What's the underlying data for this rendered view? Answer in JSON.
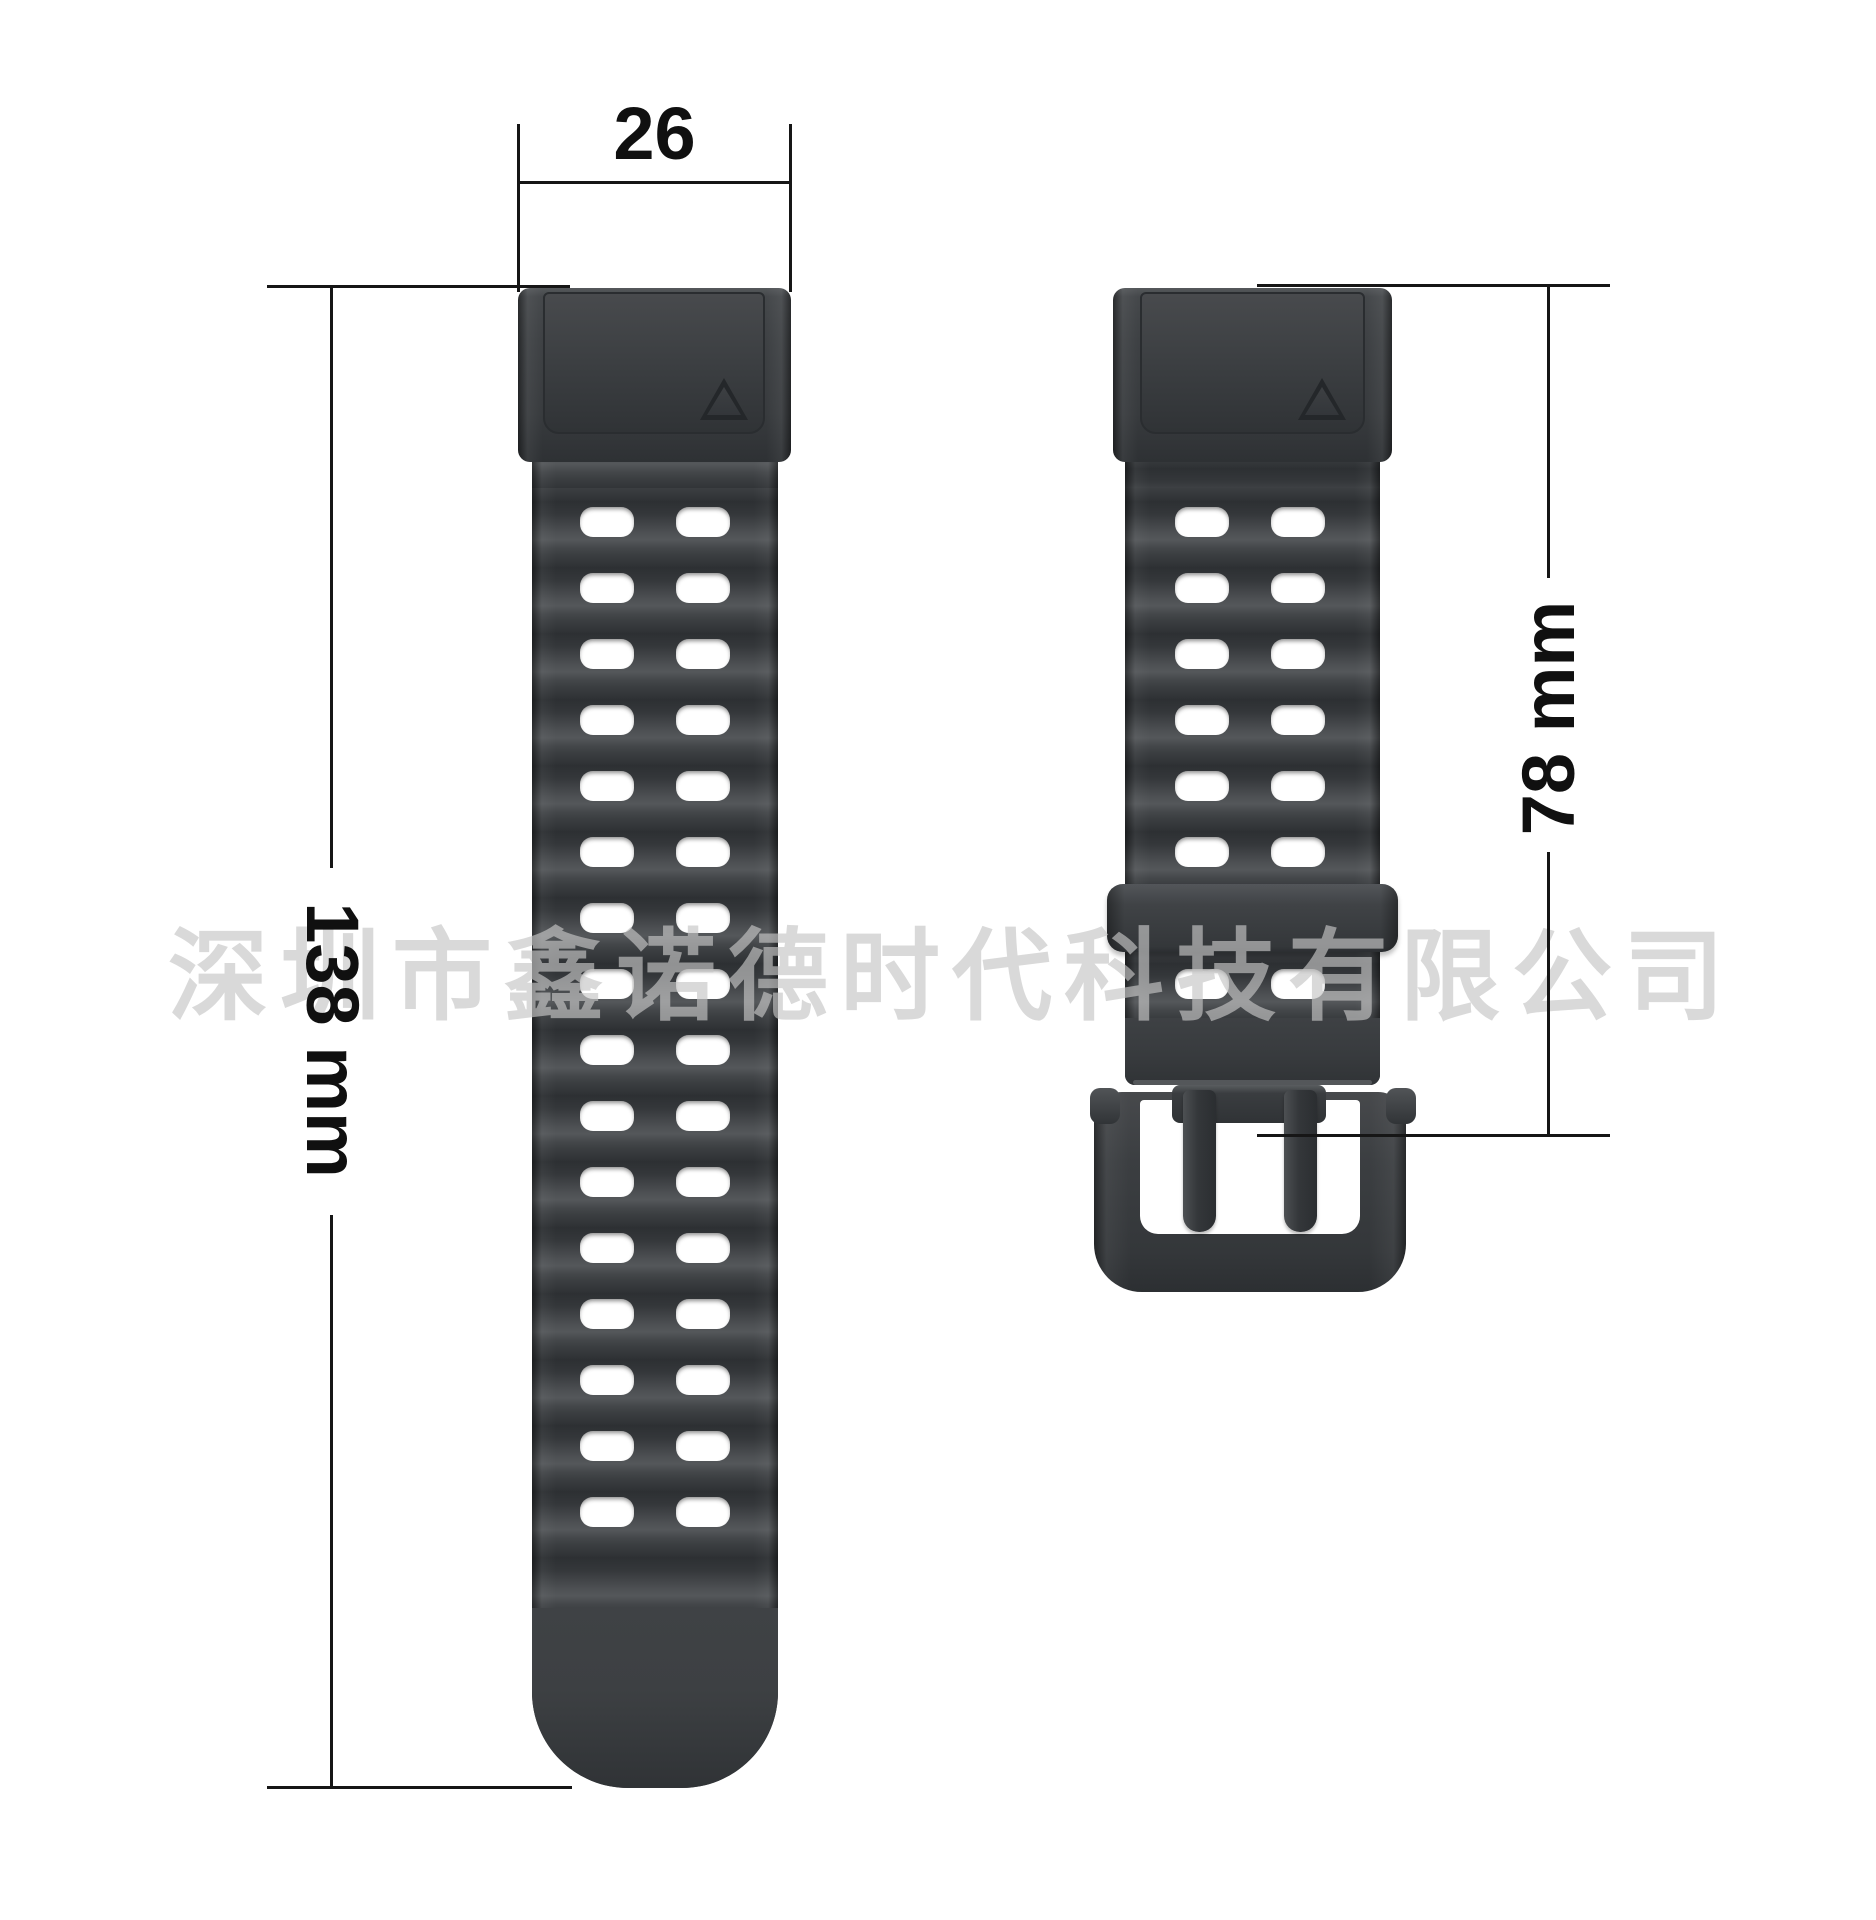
{
  "watermark_text": "深圳市鑫诺德时代科技有限公司",
  "dimensions": {
    "band_width_label": "26",
    "long_strap_length_label": "138 mm",
    "short_strap_length_label": "78 mm"
  },
  "straps": {
    "long_strap": {
      "name": "long-strap-with-holes",
      "hole_columns": 2,
      "hole_rows": 16,
      "marker": "triangle-marker"
    },
    "short_strap": {
      "name": "short-strap-with-buckle",
      "hole_columns": 2,
      "hole_rows_above_keeper": 6,
      "hole_rows_below_keeper": 1,
      "marker": "triangle-marker",
      "hardware": [
        "keeper-loop",
        "buckle",
        "buckle-prongs"
      ]
    }
  },
  "colors": {
    "background": "#ffffff",
    "strap_dark": "#35383b",
    "strap_highlight": "#54575a",
    "hole": "#ffffff",
    "dimension_line": "#161616",
    "watermark_gray": "#c6c6c6"
  }
}
